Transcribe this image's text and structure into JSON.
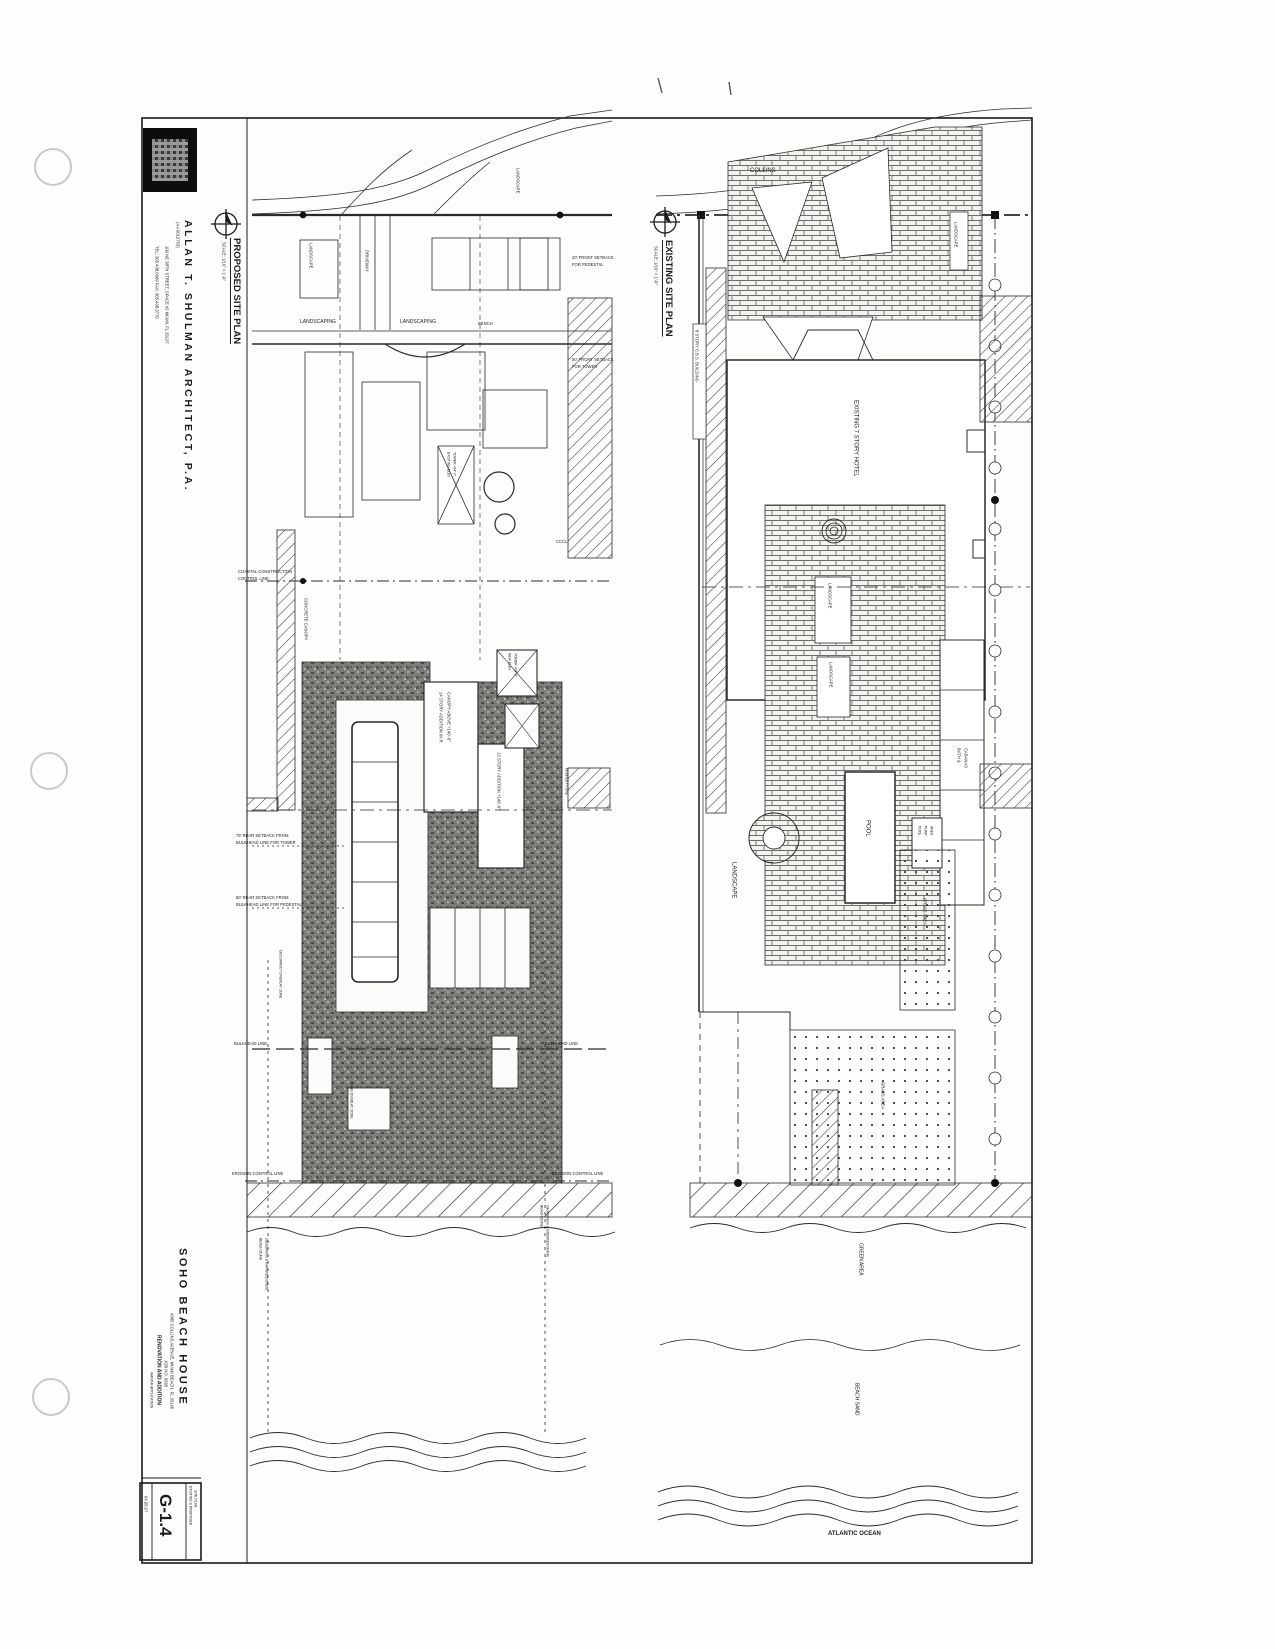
{
  "titleblock": {
    "architect_name": "ALLAN T. SHULMAN ARCHITECT, P.A.",
    "license": "(AA 0012763)",
    "address": "100 NE 38TH STREET, SPACE #2   MIAMI, FL 33137",
    "phone": "TEL: 305.438.0609   FAX: 305.438.0770",
    "project_name": "SOHO BEACH HOUSE",
    "project_address": "4385 COLLINS AVENUE, MIAMI BEACH, FL 33140",
    "job_no": "JOB NO. 0505",
    "project_type": "RENOVATION AND ADDITION",
    "submission": "WAIVER APPLICATION",
    "sheet_number": "G-1.4",
    "sheet_title_1": "EXISTING & PROPOSED",
    "sheet_title_2": "SITE PLAN",
    "date": "04.05.07"
  },
  "proposed": {
    "title": "PROPOSED SITE PLAN",
    "scale": "SCALE: 1/16\" = 1'-0\"",
    "labels": {
      "landscape_tl": "LANDSCAPE",
      "landscape_tr": "LANDSCAPE",
      "driveway": "DRIVEWAY",
      "landscaping_l": "LANDSCAPING",
      "landscaping_r": "LANDSCAPING",
      "bench": "BENCH",
      "cccl_1": "COASTAL CONSTRUCTION",
      "cccl_2": "CONTROL LINE",
      "cccl_short": "CCCL",
      "concrete_canopy": "CONCRETE CANOPY",
      "exist_elev_1": "EXISTING ELEV",
      "exist_elev_2": "TOWER +64'-0\"",
      "new_elev_1": "NEW ELEV",
      "new_elev_2": "TOWER +64'-0\"",
      "addition14_1": "14 STORY ADDITION IN R",
      "addition14_2": "CANOPY ABOVE +140'-6\"",
      "addition13": "13 STORY ADDITION +140'-6\"",
      "front_ped_1": "20' FRONT SETBACK",
      "front_ped_2": "FOR PEDESTAL",
      "front_twr_1": "50' FRONT SETBACK",
      "front_twr_2": "FOR TOWER",
      "rear75_1": "75' REAR SETBACK FROM",
      "rear75_2": "BULKHEAD LINE FOR TOWER",
      "rear50_1": "50' REAR SETBACK FROM",
      "rear50_2": "BULKHEAD LINE FOR PEDESTAL",
      "property_line": "PROPERTY LINE",
      "occupancy_zone": "OCCUPANCY OVERLAY ZONE",
      "dune_zone": "DUNE OVERLAY ZONE",
      "bulkhead_l": "BULKHEAD LINE",
      "bulkhead_r": "BULKHEAD LINE",
      "erosion_l": "EROSION CONTROL LINE",
      "erosion_r": "EROSION CONTROL LINE",
      "beach_dune_l1": "BEACH DUNE",
      "beach_dune_l2": "(SEAGRASS & GROUNDCOVER)",
      "beach_dune_r1": "BEACH DUNE",
      "beach_dune_r2": "(SEAGRASS & GROUNDCOVER)"
    }
  },
  "existing": {
    "title": "EXISTING SITE PLAN",
    "scale": "SCALE: 1/16\" = 1'-0\"",
    "labels": {
      "collins": "COLLINS",
      "landscape_tr": "LANDSCAPE",
      "cbs": "8 STORY C.B.S. BUILDING",
      "hotel": "EXISTING 7 STORY HOTEL",
      "landscape_1": "LANDSCAPE",
      "landscape_2": "LANDSCAPE",
      "landscape_lawn": "LANDSCAPE",
      "pool": "POOL",
      "bath_1": "BATH &",
      "bath_2": "CABANAS",
      "pump_1": "POOL",
      "pump_2": "PUMP",
      "pump_3": "AREA",
      "grass_1": "GRASS AREA",
      "grass_2": "GRASS AREA",
      "green_area": "GREEN AREA",
      "beach_sand": "BEACH SAND",
      "atlantic": "ATLANTIC OCEAN"
    }
  }
}
